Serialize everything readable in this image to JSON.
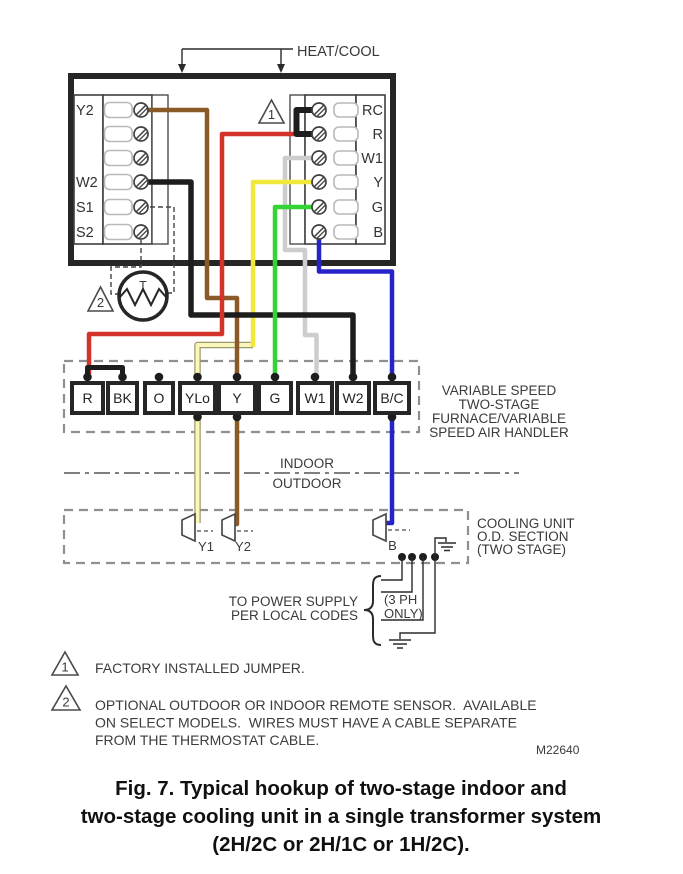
{
  "title": "HVAC two-stage wiring diagram",
  "colors": {
    "red": "#d2342c",
    "brown": "#8a5a28",
    "yellow": "#f1e83c",
    "pale_yellow": "#fbf7bc",
    "pale_yellow_edge": "#9b9b6f",
    "green": "#35d435",
    "gray_wire": "#cdcdcd",
    "blue": "#2424c8",
    "black_wire": "#1d1d1d"
  },
  "header": {
    "heat_cool": "HEAT/COOL"
  },
  "thermostat": {
    "left_terminals": [
      "Y2",
      "",
      "",
      "W2",
      "S1",
      "S2"
    ],
    "right_terminals": [
      "RC",
      "R",
      "W1",
      "Y",
      "G",
      "B"
    ],
    "sensor_label": "T"
  },
  "markers": {
    "note1": "1",
    "note2": "2"
  },
  "furnace_strip": {
    "terminals": [
      "R",
      "BK",
      "O",
      "YLo",
      "Y",
      "G",
      "W1",
      "W2",
      "B/C"
    ],
    "label_lines": [
      "VARIABLE SPEED",
      "TWO-STAGE",
      "FURNACE/VARIABLE",
      "SPEED AIR HANDLER"
    ]
  },
  "divider": {
    "indoor": "INDOOR",
    "outdoor": "OUTDOOR"
  },
  "cooling_unit": {
    "terminals": [
      "Y1",
      "Y2",
      "B"
    ],
    "label_lines": [
      "COOLING UNIT",
      "O.D. SECTION",
      "(TWO STAGE)"
    ]
  },
  "power": {
    "line1": "TO POWER SUPPLY",
    "line2": "PER LOCAL CODES",
    "ph1": "(3 PH",
    "ph2": "ONLY)"
  },
  "notes": {
    "n1_text": "FACTORY INSTALLED JUMPER.",
    "n2_line1": "OPTIONAL OUTDOOR OR INDOOR REMOTE SENSOR.  AVAILABLE",
    "n2_line2": "ON SELECT MODELS.  WIRES MUST HAVE A CABLE SEPARATE",
    "n2_line3": "FROM THE THERMOSTAT CABLE.",
    "doc_number": "M22640"
  },
  "caption": {
    "line1": "Fig. 7. Typical hookup of two-stage indoor and",
    "line2": "two-stage cooling unit in a single transformer system",
    "line3": "(2H/2C or 2H/1C or 1H/2C)."
  },
  "wires": [
    {
      "from": "thermostat.RC",
      "to": "thermostat.R",
      "color": "black",
      "note": "factory jumper"
    },
    {
      "from": "thermostat.R",
      "to": "strip.R",
      "color": "red"
    },
    {
      "from": "thermostat.W1",
      "to": "strip.W1",
      "color": "white"
    },
    {
      "from": "thermostat.Y",
      "to": "strip.YLo",
      "color": "yellow"
    },
    {
      "from": "thermostat.G",
      "to": "strip.G",
      "color": "green"
    },
    {
      "from": "thermostat.B",
      "to": "strip.B/C",
      "color": "blue"
    },
    {
      "from": "thermostat.Y2",
      "to": "strip.Y",
      "color": "brown"
    },
    {
      "from": "thermostat.W2",
      "to": "strip.W2",
      "color": "black"
    },
    {
      "from": "thermostat.S1/S2",
      "to": "remote-sensor",
      "color": "dashed"
    },
    {
      "from": "strip.R",
      "to": "strip.BK",
      "color": "black",
      "note": "jumper"
    },
    {
      "from": "strip.YLo",
      "to": "cooling.Y1",
      "color": "pale yellow"
    },
    {
      "from": "strip.Y",
      "to": "cooling.Y2",
      "color": "brown"
    },
    {
      "from": "strip.B/C",
      "to": "cooling.B",
      "color": "blue"
    }
  ]
}
